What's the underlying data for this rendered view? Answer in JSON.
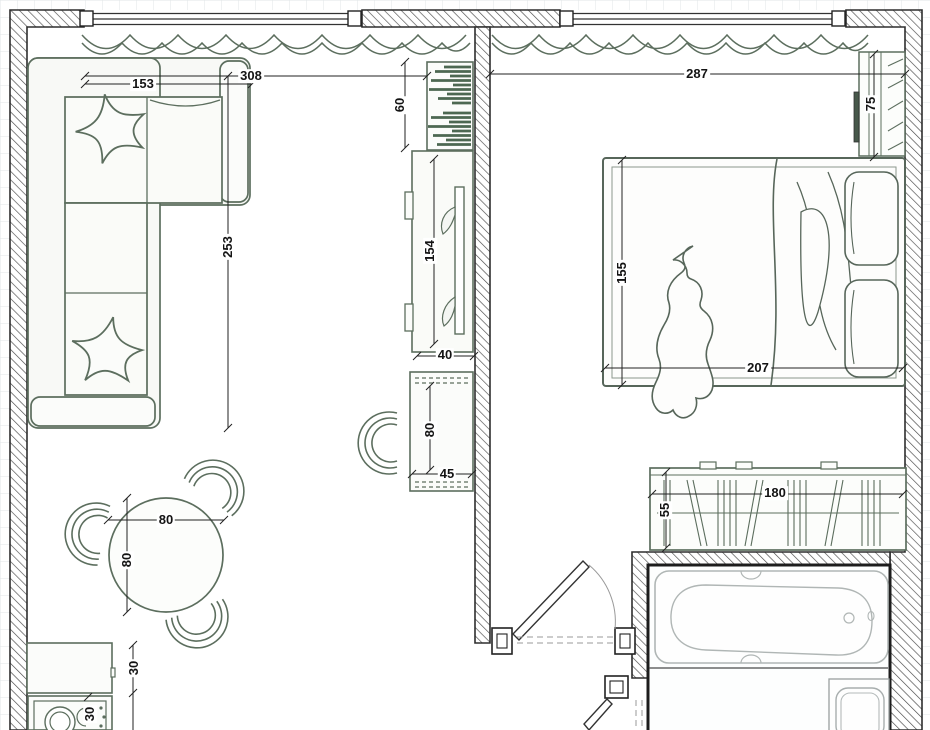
{
  "drawing": {
    "kind": "apartment-floor-plan",
    "rooms": [
      "living-room-kitchen",
      "bedroom",
      "bathroom",
      "hallway"
    ]
  },
  "dims": [
    {
      "name": "sofa-length",
      "text": "153"
    },
    {
      "name": "living-room-width",
      "text": "308"
    },
    {
      "name": "sofa-depth",
      "text": "253"
    },
    {
      "name": "shelf-unit-height",
      "text": "60"
    },
    {
      "name": "tv-unit-length",
      "text": "154"
    },
    {
      "name": "unit-desk-gap",
      "text": "40"
    },
    {
      "name": "desk-length",
      "text": "80"
    },
    {
      "name": "desk-depth",
      "text": "45"
    },
    {
      "name": "table-width",
      "text": "80"
    },
    {
      "name": "table-depth",
      "text": "80"
    },
    {
      "name": "counter-depth",
      "text": "30"
    },
    {
      "name": "washer-width",
      "text": "30"
    },
    {
      "name": "bedroom-width",
      "text": "287"
    },
    {
      "name": "bed-width",
      "text": "155"
    },
    {
      "name": "bed-length",
      "text": "207"
    },
    {
      "name": "bedroom-cabinet-length",
      "text": "75"
    },
    {
      "name": "wardrobe-length",
      "text": "180"
    },
    {
      "name": "wardrobe-depth",
      "text": "55"
    }
  ],
  "furniture_icons": [
    "corner-sofa",
    "throw-pillow",
    "dining-table",
    "chair",
    "bookshelf",
    "tv-cabinet",
    "desk",
    "double-bed",
    "pillows",
    "figure-on-bed",
    "wardrobe",
    "sliding-wardrobe",
    "bathtub",
    "sink",
    "washing-machine",
    "kitchen-counter",
    "window",
    "curtain",
    "door-swing"
  ],
  "colors": {
    "furniture_line": "#5c6e5e",
    "wall_line": "#2e2e2e",
    "dimension_text": "#141414",
    "fixture_line": "#aab1b0",
    "grid_line": "#e0e6e7",
    "paper": "#ffffff"
  }
}
